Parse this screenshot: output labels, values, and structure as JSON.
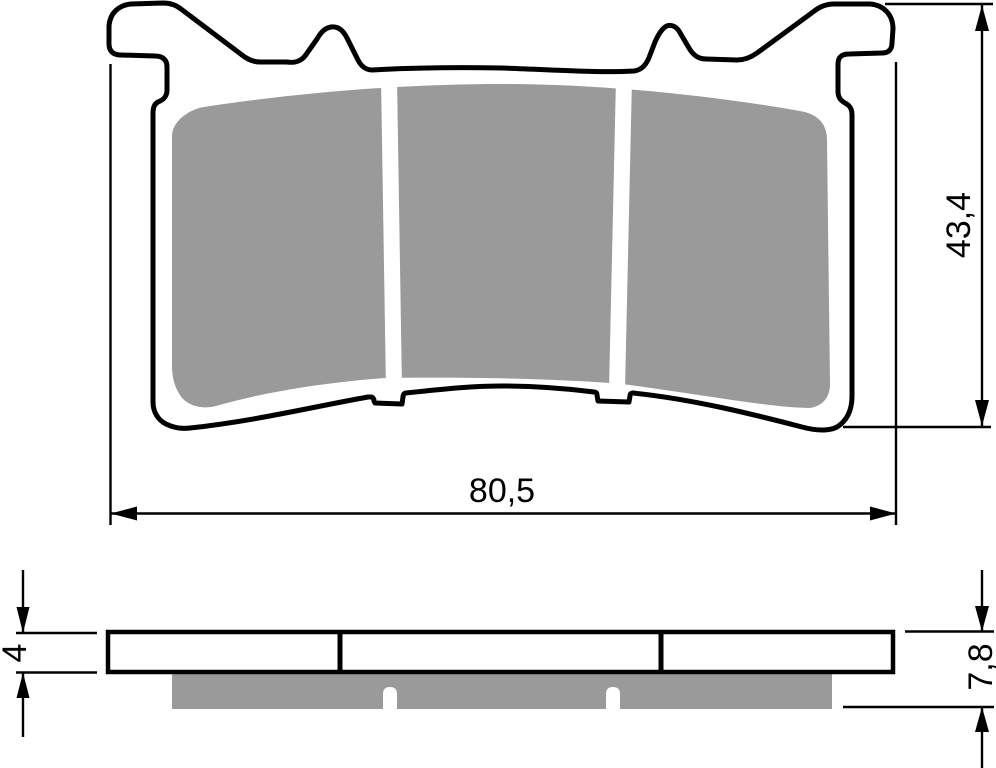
{
  "drawing": {
    "type": "technical-drawing",
    "subject": "disc brake pad - front profile view and side thickness view",
    "front_view": {
      "width_dimension": "80,5",
      "height_dimension": "43,4"
    },
    "side_view": {
      "plate_thickness_dimension": "4",
      "total_thickness_dimension": "7,8"
    },
    "colors": {
      "line": "#000000",
      "friction_material": "#9a9a9a",
      "background": "#ffffff"
    }
  }
}
